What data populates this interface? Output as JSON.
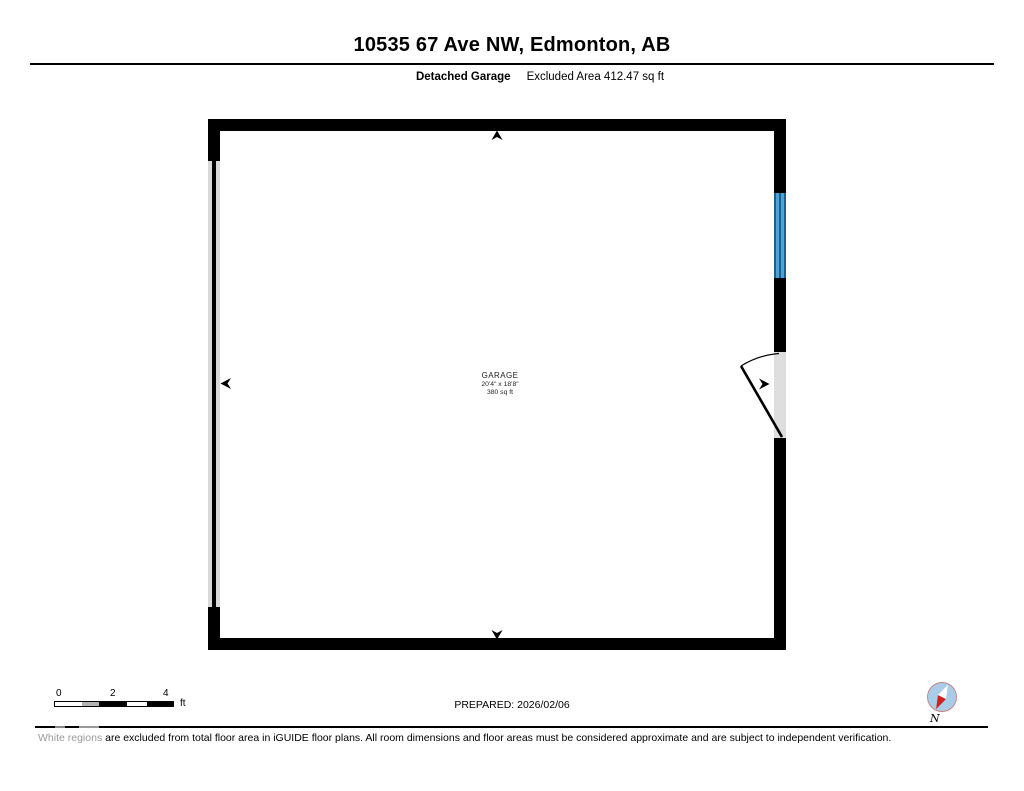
{
  "header": {
    "title": "10535 67 Ave NW, Edmonton, AB",
    "floor_label": "Detached Garage",
    "excluded_area": "Excluded Area 412.47 sq ft"
  },
  "room": {
    "name": "GARAGE",
    "dimensions": "20'4\" x 18'8\"",
    "area": "380 sq ft"
  },
  "scale_bar": {
    "tick_0": "0",
    "tick_2": "2",
    "tick_4": "4",
    "unit": "ft"
  },
  "legend": {
    "prepared": "PREPARED: 2026/02/06",
    "compass_label": "N"
  },
  "disclaimer": {
    "highlight": "White regions",
    "rest": " are excluded from total floor area in iGUIDE floor plans. All room dimensions and floor areas must be considered approximate and are subject to independent verification."
  },
  "colors": {
    "wall": "#000000",
    "window_fill": "#4aa3d4",
    "window_edge": "#1d5e8a",
    "garage_door_fill": "#d9d9d9",
    "door_opening_fill": "#dedede",
    "compass_fill": "#a9cde9",
    "compass_ring": "#c98080",
    "compass_needle": "#d42020",
    "disclaimer_highlight": "#9a9a9a"
  }
}
